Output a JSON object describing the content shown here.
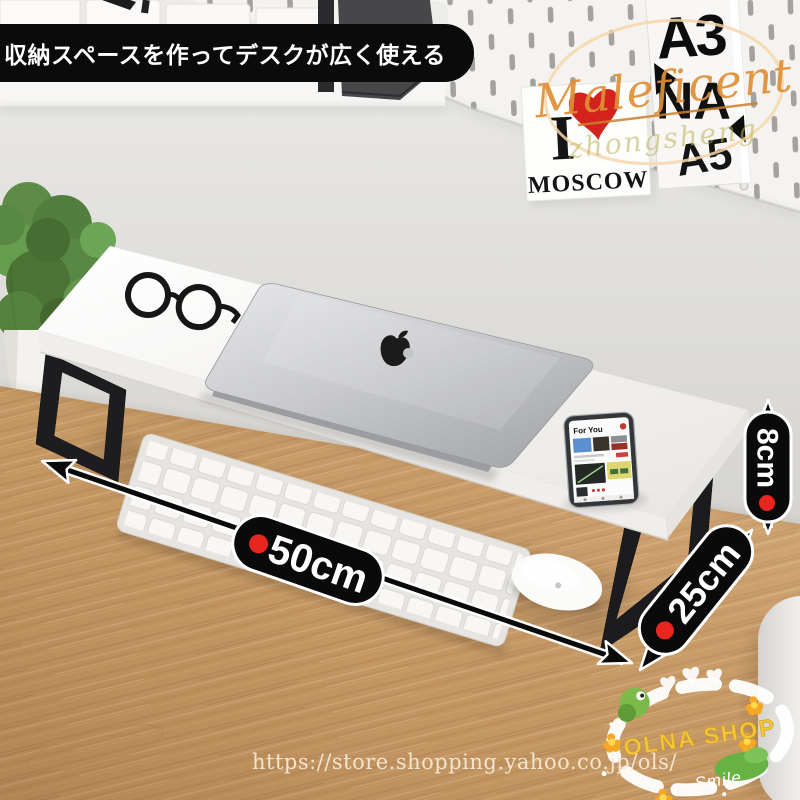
{
  "banner": {
    "text": "収納スペースを作ってデスクが広く使える"
  },
  "watermark": {
    "brand": "Maleficent",
    "signature": "zhongsheng"
  },
  "wall_posters": {
    "a3_line1": "A3",
    "a3_line2": "NA",
    "a3_line3": "A5",
    "moscow_prefix": "I",
    "moscow_city": "MOSCOW"
  },
  "dimensions": {
    "width": "50cm",
    "depth": "25cm",
    "height": "8cm"
  },
  "phone": {
    "screen_title": "For You"
  },
  "shop_stamp": {
    "name": "OLNA SHOP",
    "tagline": "Smile"
  },
  "footer": {
    "url": "https://store.shopping.yahoo.co.jp/ols/"
  },
  "colors": {
    "accent_red": "#e8251f",
    "capsule_black": "#0a0a0a",
    "brand_gold": "#df8f35",
    "stamp_yellow": "#f2c83b",
    "wood": "#c89a66",
    "wall": "#dcdbd8"
  }
}
